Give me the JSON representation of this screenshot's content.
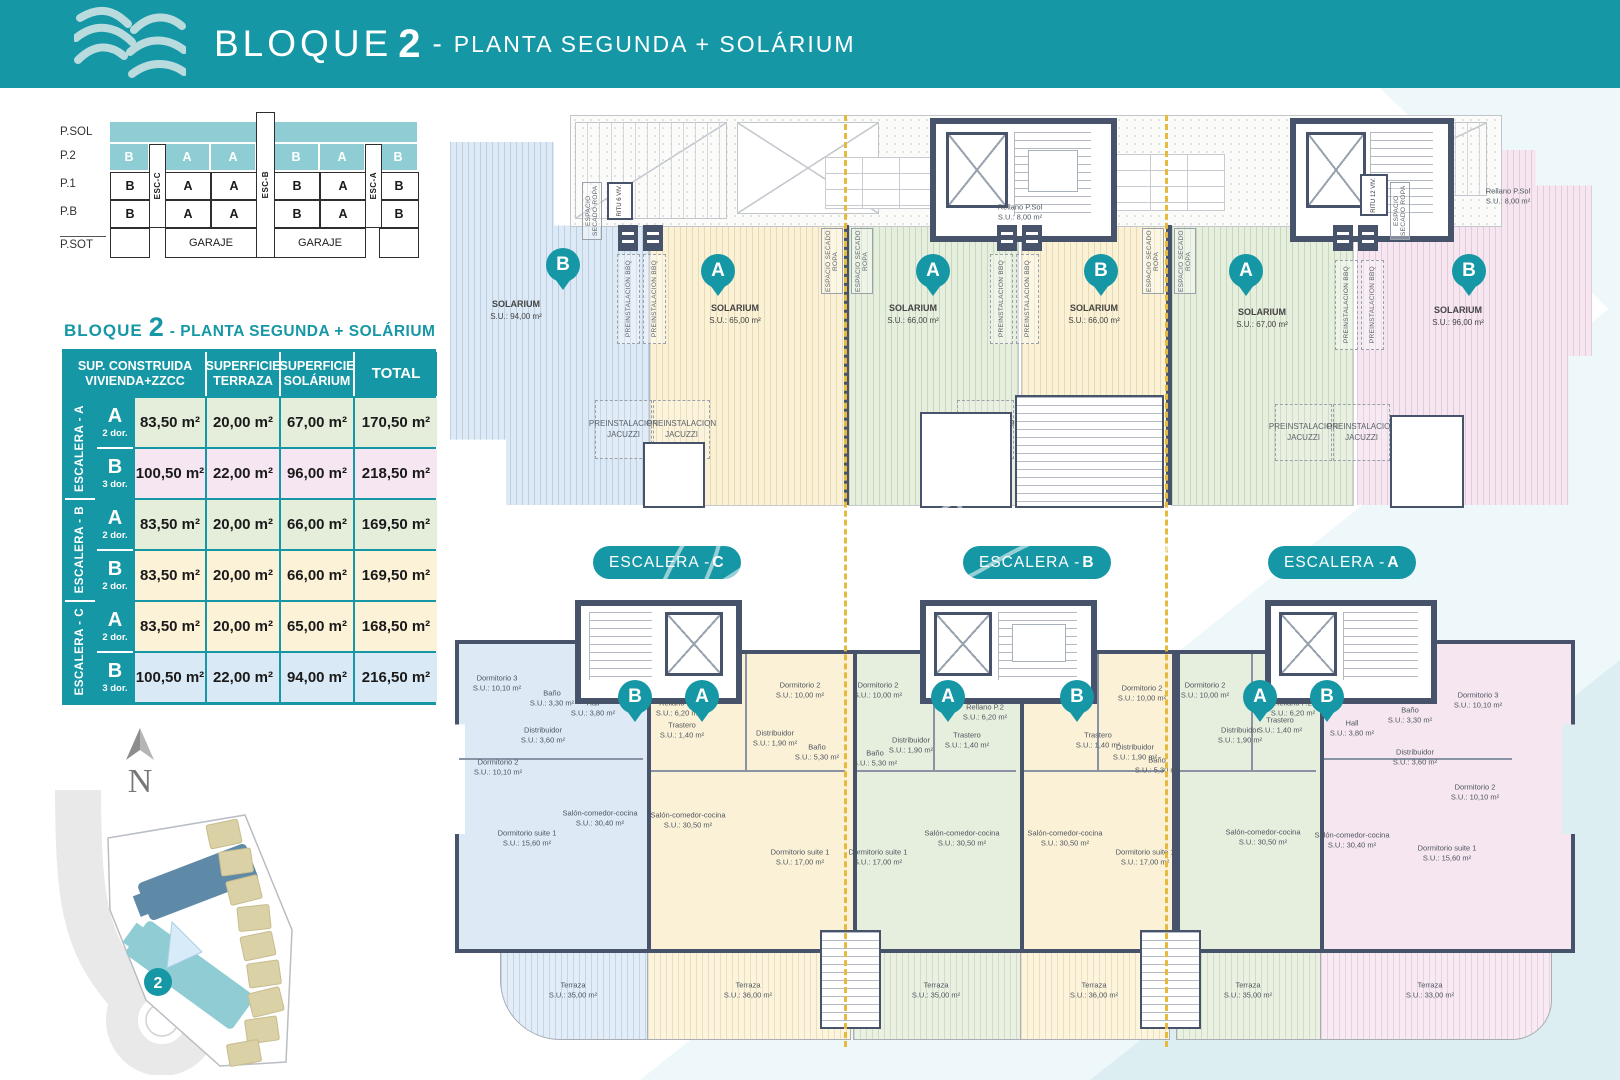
{
  "colors": {
    "teal": "#1697a5",
    "teal_light": "#8ecdd3",
    "wall": "#47536a",
    "dashed": "#e5ba3e"
  },
  "header": {
    "title": "BLOQUE",
    "num": "2",
    "dash": "-",
    "subtitle": "PLANTA SEGUNDA + SOLÁRIUM"
  },
  "stack": {
    "rows": [
      "P.SOL",
      "P.2",
      "P.1",
      "P.B",
      "P.SOT"
    ],
    "p2": [
      "B",
      "A",
      "A",
      "B",
      "A",
      "B"
    ],
    "p1": [
      "B",
      "A",
      "A",
      "B",
      "A",
      "B"
    ],
    "pb": [
      "B",
      "A",
      "A",
      "B",
      "A",
      "B"
    ],
    "esc": [
      "ESC-C",
      "ESC-B",
      "ESC-A"
    ],
    "garaje": "GARAJE"
  },
  "table": {
    "title": {
      "b": "BLOQUE",
      "n": "2",
      "r": "- PLANTA SEGUNDA + SOLÁRIUM"
    },
    "h": {
      "c1a": "SUP. CONSTRUIDA",
      "c1b": "VIVIENDA+ZZCC",
      "c2a": "SUPERFICIE",
      "c2b": "TERRAZA",
      "c3a": "SUPERFICIE",
      "c3b": "SOLÁRIUM",
      "c4": "TOTAL"
    },
    "groups": [
      {
        "esc": "ESCALERA - A",
        "rows": [
          {
            "u": "A",
            "d": "2 dor.",
            "s1": "83,50 m²",
            "s2": "20,00 m²",
            "s3": "67,00 m²",
            "s4": "170,50 m²"
          },
          {
            "u": "B",
            "d": "3 dor.",
            "s1": "100,50 m²",
            "s2": "22,00 m²",
            "s3": "96,00 m²",
            "s4": "218,50 m²"
          }
        ]
      },
      {
        "esc": "ESCALERA - B",
        "rows": [
          {
            "u": "A",
            "d": "2 dor.",
            "s1": "83,50 m²",
            "s2": "20,00 m²",
            "s3": "66,00 m²",
            "s4": "169,50 m²"
          },
          {
            "u": "B",
            "d": "2 dor.",
            "s1": "83,50 m²",
            "s2": "20,00 m²",
            "s3": "66,00 m²",
            "s4": "169,50 m²"
          }
        ]
      },
      {
        "esc": "ESCALERA - C",
        "rows": [
          {
            "u": "A",
            "d": "2 dor.",
            "s1": "83,50 m²",
            "s2": "20,00 m²",
            "s3": "65,00 m²",
            "s4": "168,50 m²"
          },
          {
            "u": "B",
            "d": "3 dor.",
            "s1": "100,50 m²",
            "s2": "22,00 m²",
            "s3": "94,00 m²",
            "s4": "216,50 m²"
          }
        ]
      }
    ]
  },
  "compass": {
    "letter": "N"
  },
  "site": {
    "badge": "2"
  },
  "top_plan": {
    "solarium": "SOLARIUM",
    "units": [
      {
        "pin": "B",
        "area": "S.U.: 94,00 m²"
      },
      {
        "pin": "A",
        "area": "S.U.: 65,00 m²"
      },
      {
        "pin": "A",
        "area": "S.U.: 66,00 m²"
      },
      {
        "pin": "B",
        "area": "S.U.: 66,00 m²"
      },
      {
        "pin": "A",
        "area": "S.U.: 67,00 m²"
      },
      {
        "pin": "B",
        "area": "S.U.: 96,00 m²"
      }
    ],
    "jacuzzi": "PREINSTALACION JACUZZI",
    "bbq": "PREINSTALACION BBQ",
    "secado": "ESPACIO SECADO ROPA",
    "ritu_l": "RITU 6 VIV.",
    "ritu_r": "RITU 12 VIV.",
    "rellano": {
      "n": "Rellano P.Sol",
      "a": "S.U.: 8,00 m²"
    }
  },
  "pills": [
    {
      "p": "ESCALERA - ",
      "l": "C"
    },
    {
      "p": "ESCALERA - ",
      "l": "B"
    },
    {
      "p": "ESCALERA - ",
      "l": "A"
    }
  ],
  "bottom_plan": {
    "pins": [
      "B",
      "A",
      "A",
      "B",
      "A",
      "B"
    ],
    "rellano": {
      "n": "Rellano P.2",
      "a": "S.U.: 6,20 m²"
    },
    "apartments": [
      {
        "id": "esc-c-b",
        "rooms": [
          {
            "n": "Dormitorio 3",
            "a": "S.U.: 10,10 m²"
          },
          {
            "n": "Baño",
            "a": "S.U.: 3,30 m²"
          },
          {
            "n": "Hall",
            "a": "S.U.: 3,80 m²"
          },
          {
            "n": "Distribuidor",
            "a": "S.U.: 3,60 m²"
          },
          {
            "n": "Dormitorio 2",
            "a": "S.U.: 10,10 m²"
          },
          {
            "n": "Dormitorio suite 1",
            "a": "S.U.: 15,60 m²"
          },
          {
            "n": "Salón-comedor-cocina",
            "a": "S.U.: 30,40 m²"
          }
        ]
      },
      {
        "id": "esc-c-a",
        "rooms": [
          {
            "n": "Trastero",
            "a": "S.U.: 1,40 m²"
          },
          {
            "n": "Dormitorio 2",
            "a": "S.U.: 10,00 m²"
          },
          {
            "n": "Distribuidor",
            "a": "S.U.: 1,90 m²"
          },
          {
            "n": "Baño",
            "a": "S.U.: 5,30 m²"
          },
          {
            "n": "Dormitorio suite 1",
            "a": "S.U.: 17,00 m²"
          },
          {
            "n": "Salón-comedor-cocina",
            "a": "S.U.: 30,50 m²"
          }
        ]
      },
      {
        "id": "esc-b-a",
        "rooms": [
          {
            "n": "Dormitorio 2",
            "a": "S.U.: 10,00 m²"
          },
          {
            "n": "Trastero",
            "a": "S.U.: 1,40 m²"
          },
          {
            "n": "Distribuidor",
            "a": "S.U.: 1,90 m²"
          },
          {
            "n": "Baño",
            "a": "S.U.: 5,30 m²"
          },
          {
            "n": "Dormitorio suite 1",
            "a": "S.U.: 17,00 m²"
          },
          {
            "n": "Salón-comedor-cocina",
            "a": "S.U.: 30,50 m²"
          }
        ]
      },
      {
        "id": "esc-b-b",
        "rooms": [
          {
            "n": "Dormitorio 2",
            "a": "S.U.: 10,00 m²"
          },
          {
            "n": "Trastero",
            "a": "S.U.: 1,40 m²"
          },
          {
            "n": "Distribuidor",
            "a": "S.U.: 1,90 m²"
          },
          {
            "n": "Baño",
            "a": "S.U.: 5,30 m²"
          },
          {
            "n": "Dormitorio suite 1",
            "a": "S.U.: 17,00 m²"
          },
          {
            "n": "Salón-comedor-cocina",
            "a": "S.U.: 30,50 m²"
          }
        ]
      },
      {
        "id": "esc-a-a",
        "rooms": [
          {
            "n": "Dormitorio 2",
            "a": "S.U.: 10,00 m²"
          },
          {
            "n": "Distribuidor",
            "a": "S.U.: 1,90 m²"
          },
          {
            "n": "Trastero",
            "a": "S.U.: 1,40 m²"
          },
          {
            "n": "Salón-comedor-cocina",
            "a": "S.U.: 30,50 m²"
          }
        ]
      },
      {
        "id": "esc-a-b",
        "rooms": [
          {
            "n": "Hall",
            "a": "S.U.: 3,80 m²"
          },
          {
            "n": "Baño",
            "a": "S.U.: 3,30 m²"
          },
          {
            "n": "Dormitorio 3",
            "a": "S.U.: 10,10 m²"
          },
          {
            "n": "Distribuidor",
            "a": "S.U.: 3,60 m²"
          },
          {
            "n": "Dormitorio 2",
            "a": "S.U.: 10,10 m²"
          },
          {
            "n": "Dormitorio suite 1",
            "a": "S.U.: 15,60 m²"
          },
          {
            "n": "Salón-comedor-cocina",
            "a": "S.U.: 30,40 m²"
          }
        ]
      }
    ],
    "terrazas": [
      {
        "n": "Terraza",
        "a": "S.U.: 35,00 m²"
      },
      {
        "n": "Terraza",
        "a": "S.U.: 36,00 m²"
      },
      {
        "n": "Terraza",
        "a": "S.U.: 35,00 m²"
      },
      {
        "n": "Terraza",
        "a": "S.U.: 36,00 m²"
      },
      {
        "n": "Terraza",
        "a": "S.U.: 35,00 m²"
      },
      {
        "n": "Terraza",
        "a": "S.U.: 33,00 m²"
      }
    ]
  }
}
